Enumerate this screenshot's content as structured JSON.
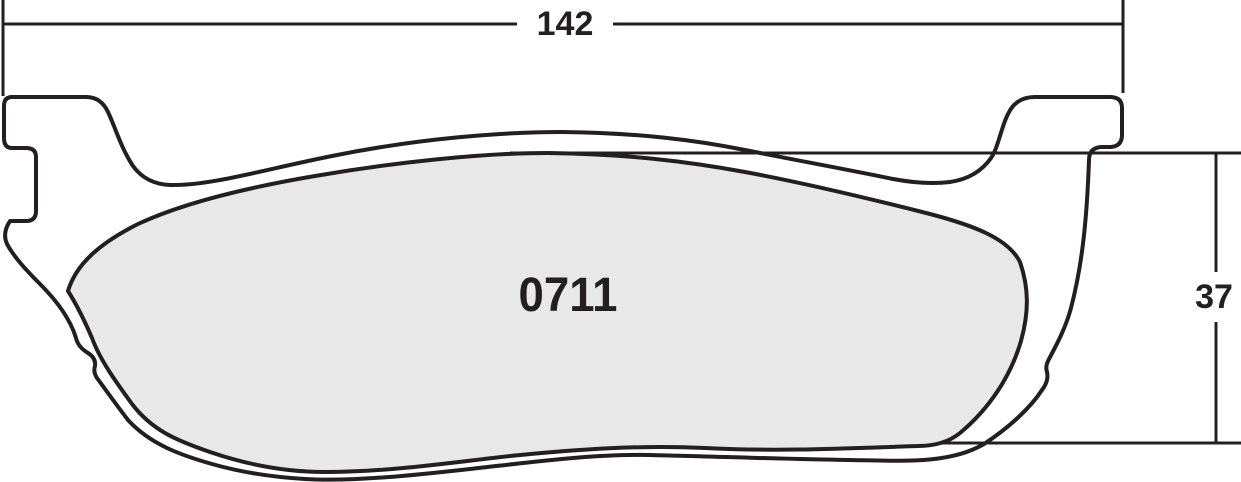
{
  "drawing": {
    "title": "brake-pad-dimension-drawing",
    "part_number": "0711",
    "dimensions": {
      "width_label": "142",
      "height_label": "37"
    },
    "colors": {
      "line": "#231f20",
      "friction_fill": "#e8e8e9",
      "background": "#ffffff"
    }
  }
}
